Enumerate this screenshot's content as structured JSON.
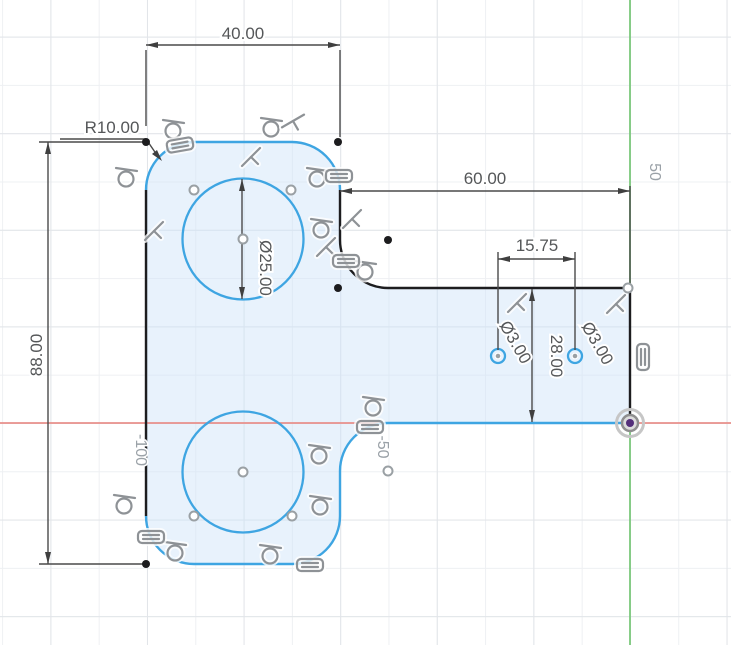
{
  "app": {
    "name": "cad-sketch-canvas",
    "mode": "sketch-edit"
  },
  "dim_labels": {
    "top_width": "40.00",
    "fillet_radius": "R10.00",
    "arm_length": "60.00",
    "hole_spacing": "15.75",
    "body_height": "88.00",
    "large_circle_diameter": "Ø25.00",
    "hole_left_diameter": "Ø3.00",
    "hole_right_diameter": "Ø3.00",
    "arm_height": "28.00"
  },
  "axis_labels": {
    "y_axis_50": "50",
    "x_axis_neg50": "-50",
    "x_axis_neg100": "-100"
  },
  "colors": {
    "sketch_unconstrained": "#3ea5e2",
    "sketch_constrained": "#1d1d1f",
    "profile_fill": "#e8f2fb",
    "x_axis": "#e8908b",
    "y_axis": "#7cc87c",
    "dimension": "#4a4a4a",
    "constraint_icon": "#8e9296",
    "origin_center": "#532f7a"
  },
  "circles": {
    "large": [
      {
        "cx": 243,
        "cy": 239,
        "r": 60.5
      },
      {
        "cx": 243,
        "cy": 472,
        "r": 60.5
      }
    ],
    "small": [
      {
        "cx": 498,
        "cy": 356,
        "r": 7
      },
      {
        "cx": 575,
        "cy": 356,
        "r": 7
      }
    ]
  },
  "constraints": [
    {
      "type": "tangent",
      "x": 174,
      "y": 127,
      "rot": 0
    },
    {
      "type": "tangent",
      "x": 127,
      "y": 175,
      "rot": 0
    },
    {
      "type": "tangent",
      "x": 272,
      "y": 125,
      "rot": 0
    },
    {
      "type": "tangent",
      "x": 318,
      "y": 175,
      "rot": 0
    },
    {
      "type": "tangent",
      "x": 322,
      "y": 226,
      "rot": 0
    },
    {
      "type": "tangent",
      "x": 366,
      "y": 268,
      "rot": 0
    },
    {
      "type": "tangent",
      "x": 374,
      "y": 404,
      "rot": 0
    },
    {
      "type": "tangent",
      "x": 320,
      "y": 452,
      "rot": 0
    },
    {
      "type": "tangent",
      "x": 321,
      "y": 503,
      "rot": 0
    },
    {
      "type": "tangent",
      "x": 176,
      "y": 549,
      "rot": 0
    },
    {
      "type": "tangent",
      "x": 271,
      "y": 552,
      "rot": 0
    },
    {
      "type": "tangent",
      "x": 125,
      "y": 502,
      "rot": 0
    },
    {
      "type": "perpendicular",
      "x": 251,
      "y": 157,
      "rot": 0
    },
    {
      "type": "perpendicular",
      "x": 154,
      "y": 231,
      "rot": 0
    },
    {
      "type": "perpendicular",
      "x": 352,
      "y": 219,
      "rot": 0
    },
    {
      "type": "perpendicular",
      "x": 326,
      "y": 247,
      "rot": 0
    },
    {
      "type": "perpendicular",
      "x": 517,
      "y": 303,
      "rot": 0
    },
    {
      "type": "perpendicular",
      "x": 616,
      "y": 304,
      "rot": 0
    },
    {
      "type": "perpendicular",
      "x": 293,
      "y": 121,
      "rot": 15
    },
    {
      "type": "equal",
      "x": 180,
      "y": 145,
      "rot": -10
    },
    {
      "type": "equal",
      "x": 339,
      "y": 176,
      "rot": 0
    },
    {
      "type": "equal",
      "x": 346,
      "y": 261,
      "rot": 0
    },
    {
      "type": "equal",
      "x": 370,
      "y": 427,
      "rot": 0
    },
    {
      "type": "equal",
      "x": 151,
      "y": 537,
      "rot": 0
    },
    {
      "type": "equal",
      "x": 310,
      "y": 565,
      "rot": 0
    },
    {
      "type": "equal",
      "x": 643,
      "y": 357,
      "rot": 90
    }
  ],
  "points": {
    "fixed": [
      [
        146,
        142
      ],
      [
        338,
        142
      ],
      [
        338,
        288
      ],
      [
        388,
        240
      ],
      [
        146,
        564
      ]
    ],
    "free": [
      [
        194,
        190
      ],
      [
        291,
        190
      ],
      [
        243,
        239
      ],
      [
        243,
        472
      ],
      [
        194,
        516
      ],
      [
        292,
        516
      ],
      [
        388,
        471
      ],
      [
        628,
        288
      ]
    ],
    "hole_centers": [
      [
        498,
        356
      ],
      [
        575,
        356
      ]
    ]
  }
}
